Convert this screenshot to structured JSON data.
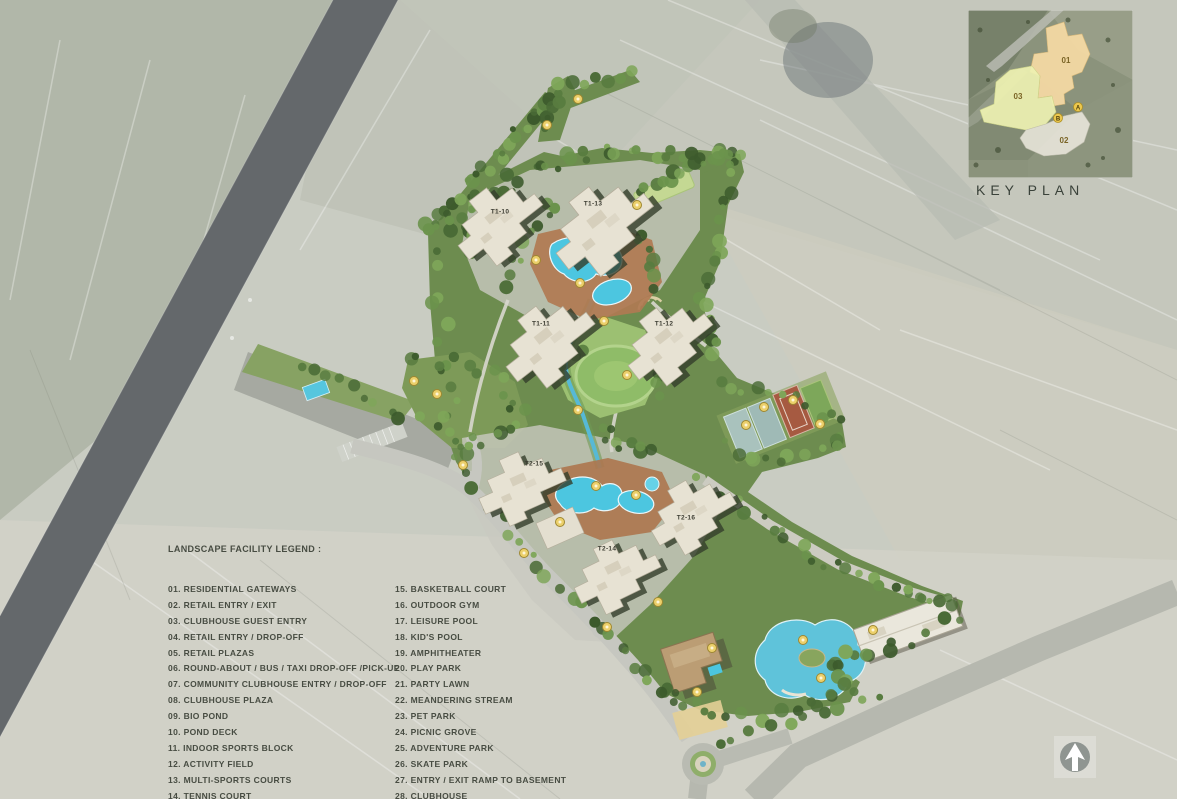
{
  "legend": {
    "title": "LANDSCAPE FACILITY LEGEND :",
    "items_left": [
      "01. RESIDENTIAL GATEWAYS",
      "02. RETAIL ENTRY / EXIT",
      "03. CLUBHOUSE GUEST ENTRY",
      "04. RETAIL ENTRY / DROP-OFF",
      "05. RETAIL PLAZAS",
      "06. ROUND-ABOUT / BUS / TAXI DROP-OFF /PICK-UP",
      "07. COMMUNITY CLUBHOUSE ENTRY / DROP-OFF",
      "08. CLUBHOUSE PLAZA",
      "09. BIO POND",
      "10. POND DECK",
      "11. INDOOR SPORTS BLOCK",
      "12. ACTIVITY FIELD",
      "13. MULTI-SPORTS COURTS",
      "14. TENNIS COURT"
    ],
    "items_right": [
      "15. BASKETBALL COURT",
      "16. OUTDOOR GYM",
      "17. LEISURE POOL",
      "18. KID'S POOL",
      "19. AMPHITHEATER",
      "20. PLAY PARK",
      "21. PARTY LAWN",
      "22. MEANDERING STREAM",
      "23. PET PARK",
      "24. PICNIC GROVE",
      "25. ADVENTURE PARK",
      "26. SKATE PARK",
      "27. ENTRY / EXIT RAMP TO BASEMENT",
      "28. CLUBHOUSE"
    ]
  },
  "key_plan": {
    "title": "KEY PLAN",
    "zones": [
      {
        "label": "01",
        "color": "#f4d9a4"
      },
      {
        "label": "03",
        "color": "#eef2b2"
      },
      {
        "label": "02",
        "color": "#e8e5da"
      }
    ],
    "points": [
      {
        "label": "A"
      },
      {
        "label": "B"
      }
    ]
  },
  "towers": [
    {
      "label": "T1-10",
      "x": 500,
      "y": 212
    },
    {
      "label": "T1-13",
      "x": 593,
      "y": 204
    },
    {
      "label": "T1-11",
      "x": 541,
      "y": 324
    },
    {
      "label": "T1-12",
      "x": 664,
      "y": 324
    },
    {
      "label": "T2-15",
      "x": 534,
      "y": 464
    },
    {
      "label": "T2-16",
      "x": 686,
      "y": 518
    },
    {
      "label": "T2-14",
      "x": 607,
      "y": 549
    }
  ],
  "markers": [
    [
      578,
      99
    ],
    [
      547,
      125
    ],
    [
      637,
      205
    ],
    [
      536,
      260
    ],
    [
      580,
      283
    ],
    [
      604,
      321
    ],
    [
      627,
      375
    ],
    [
      578,
      410
    ],
    [
      414,
      381
    ],
    [
      437,
      394
    ],
    [
      463,
      465
    ],
    [
      560,
      522
    ],
    [
      524,
      553
    ],
    [
      596,
      486
    ],
    [
      636,
      495
    ],
    [
      746,
      425
    ],
    [
      764,
      407
    ],
    [
      793,
      400
    ],
    [
      820,
      424
    ],
    [
      658,
      602
    ],
    [
      712,
      648
    ],
    [
      803,
      640
    ],
    [
      821,
      678
    ],
    [
      873,
      630
    ],
    [
      607,
      627
    ],
    [
      697,
      692
    ]
  ],
  "icons": {
    "north_arrow": "north-arrow-icon"
  },
  "colors": {
    "pool": "#4cc6e0",
    "deck": "#ad7750",
    "green": "#6d8c4f",
    "lawn": "#8fbc68",
    "building": "#e7e2d3",
    "building_shadow": "#333d2b",
    "road_dark": "#64686b",
    "marker": "#ecd06b",
    "marker_edge": "#9f8830"
  }
}
